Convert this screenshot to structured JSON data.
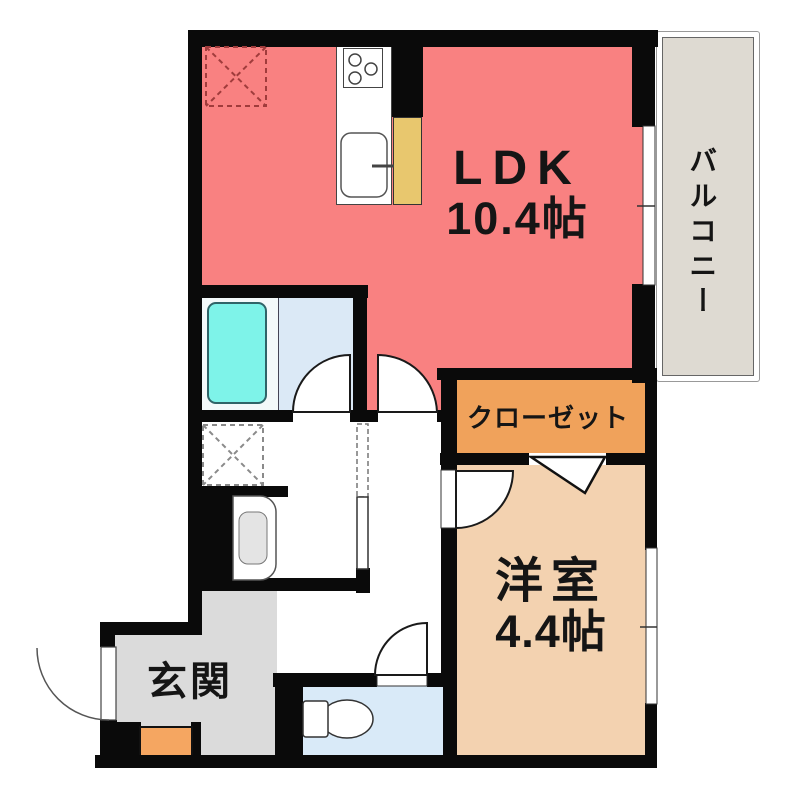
{
  "plan": {
    "rooms": {
      "ldk": {
        "name": "LDK",
        "size": "10.4帖",
        "color": "#f98181"
      },
      "western_room": {
        "name": "洋室",
        "size": "4.4帖",
        "color": "#f3d2b0"
      },
      "closet": {
        "name": "クローゼット",
        "color": "#f0a25b"
      },
      "balcony": {
        "name": "バルコニー",
        "color": "#dedad2"
      },
      "entrance": {
        "name": "玄関",
        "color": "#dbdbdb"
      },
      "bathroom": {
        "floor_color": "#dbe9f6",
        "tub_surround_color": "#f3f9fa"
      },
      "toilet": {
        "floor_color": "#d9eaf8"
      },
      "corridor": {
        "floor_color": "#ffffff"
      }
    },
    "fixtures": {
      "bathtub": {
        "color": "#7ef3e9"
      },
      "kitchen_counter": {
        "color": "#e8c76e"
      },
      "shoe_cabinet": {
        "color": "#f5a661"
      },
      "refrigerator_space": {
        "dash_color": "#a03c3c"
      },
      "washer_space": {
        "dash_color": "#8a8a8a"
      }
    },
    "wall_color": "#0a0a0a"
  }
}
